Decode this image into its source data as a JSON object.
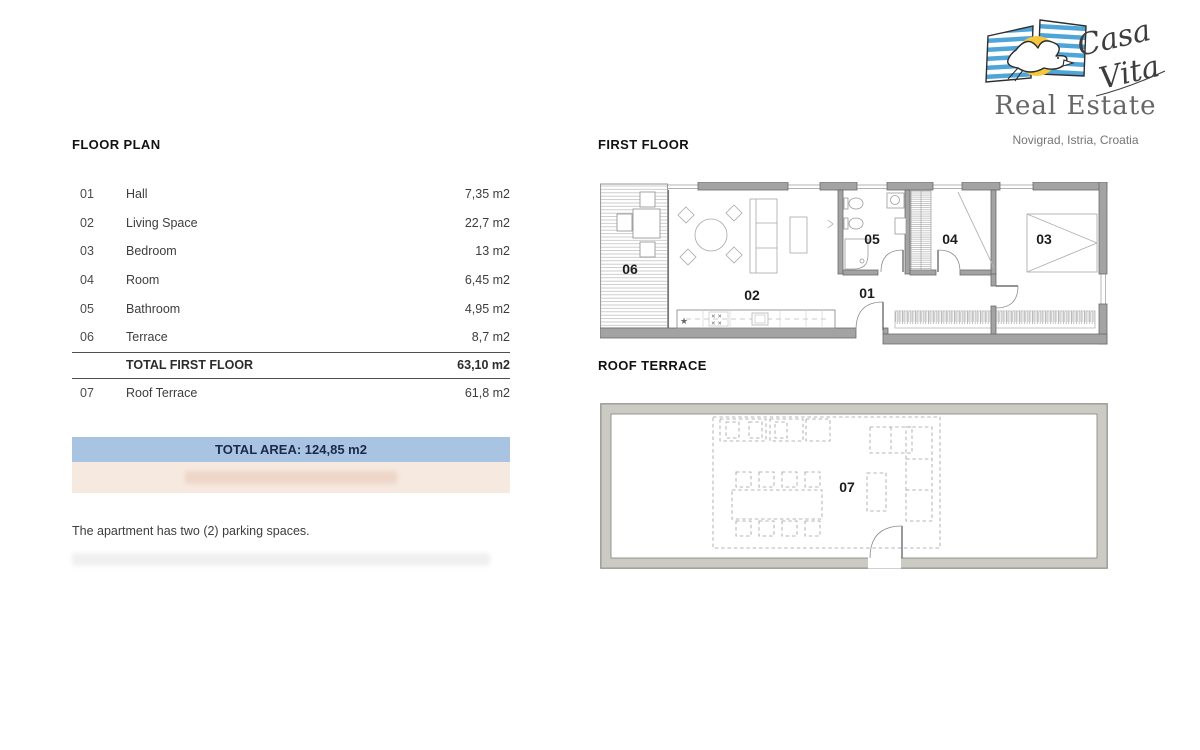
{
  "logo": {
    "brand_line1": "Casa",
    "brand_line2": "Vita",
    "subtitle": "Real Estate",
    "location": "Novigrad, Istria, Croatia"
  },
  "floor_plan": {
    "title": "FLOOR PLAN",
    "rows": [
      {
        "num": "01",
        "name": "Hall",
        "area": "7,35 m2"
      },
      {
        "num": "02",
        "name": "Living Space",
        "area": "22,7 m2"
      },
      {
        "num": "03",
        "name": "Bedroom",
        "area": "13 m2"
      },
      {
        "num": "04",
        "name": "Room",
        "area": "6,45 m2"
      },
      {
        "num": "05",
        "name": "Bathroom",
        "area": "4,95 m2"
      },
      {
        "num": "06",
        "name": "Terrace",
        "area": "8,7 m2"
      }
    ],
    "total_row": {
      "label": "TOTAL FIRST FLOOR",
      "area": "63,10 m2"
    },
    "roof_row": {
      "num": "07",
      "name": "Roof Terrace",
      "area": "61,8 m2"
    },
    "total_area_banner": "TOTAL AREA: 124,85 m2",
    "parking_note": "The apartment has two (2) parking spaces."
  },
  "plans": {
    "first_floor": {
      "title": "FIRST FLOOR",
      "room_labels": {
        "hall": "01",
        "living": "02",
        "bedroom": "03",
        "room": "04",
        "bathroom": "05",
        "terrace": "06"
      },
      "kitchen": {
        "star": "★",
        "hob": "✕ ✕"
      }
    },
    "roof_terrace": {
      "title": "ROOF TERRACE",
      "room_label": "07"
    }
  },
  "colors": {
    "banner_blue": "#a9c4e2",
    "banner_pink": "#f6e9e0",
    "wall_gray": "#a3a3a3",
    "roof_wall_gray": "#cccbc3",
    "logo_blue": "#4fa5d8",
    "logo_yellow": "#f5c73e"
  }
}
